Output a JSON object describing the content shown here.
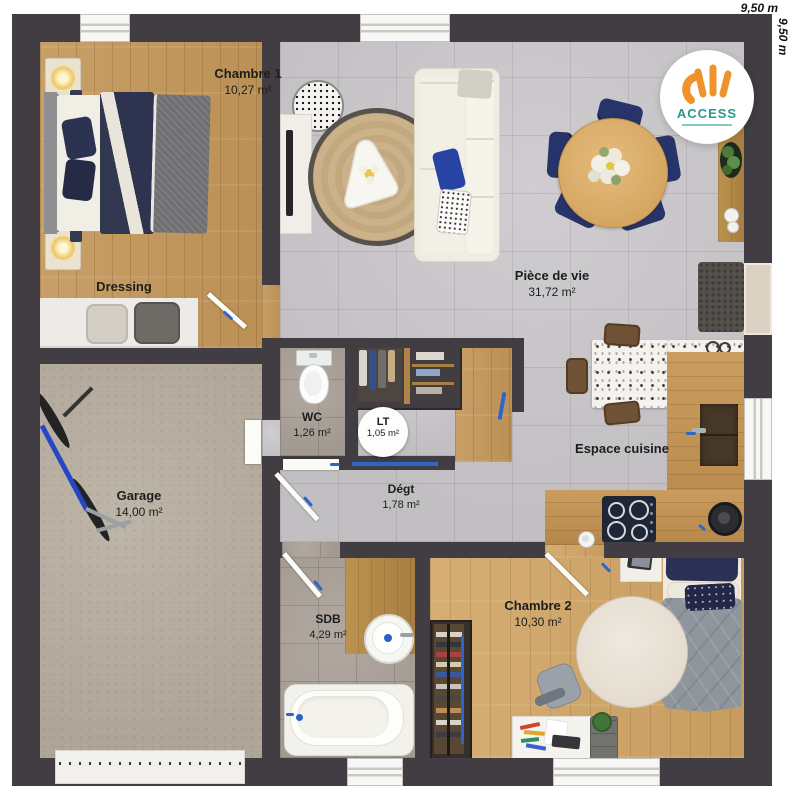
{
  "dimensions": {
    "top": "9,50 m",
    "right": "9,50 m"
  },
  "logo": {
    "brand": "ACCESS"
  },
  "rooms": {
    "chambre1": {
      "name": "Chambre 1",
      "area": "10,27 m²"
    },
    "dressing": {
      "name": "Dressing"
    },
    "garage": {
      "name": "Garage",
      "area": "14,00 m²"
    },
    "wc": {
      "name": "WC",
      "area": "1,26 m²"
    },
    "lt": {
      "name": "LT",
      "area": "1,05 m²"
    },
    "degt": {
      "name": "Dégt",
      "area": "1,78 m²"
    },
    "piece_de_vie": {
      "name": "Pièce de vie",
      "area": "31,72 m²"
    },
    "espace_cuisine": {
      "name": "Espace cuisine"
    },
    "sdb": {
      "name": "SDB",
      "area": "4,29 m²"
    },
    "chambre2": {
      "name": "Chambre 2",
      "area": "10,30 m²"
    }
  },
  "colors": {
    "wall": "#413d42",
    "accent_blue": "#2d66c8",
    "navy_furniture": "#273469",
    "logo_orange": "#f0922b",
    "logo_teal": "#279a8e"
  }
}
